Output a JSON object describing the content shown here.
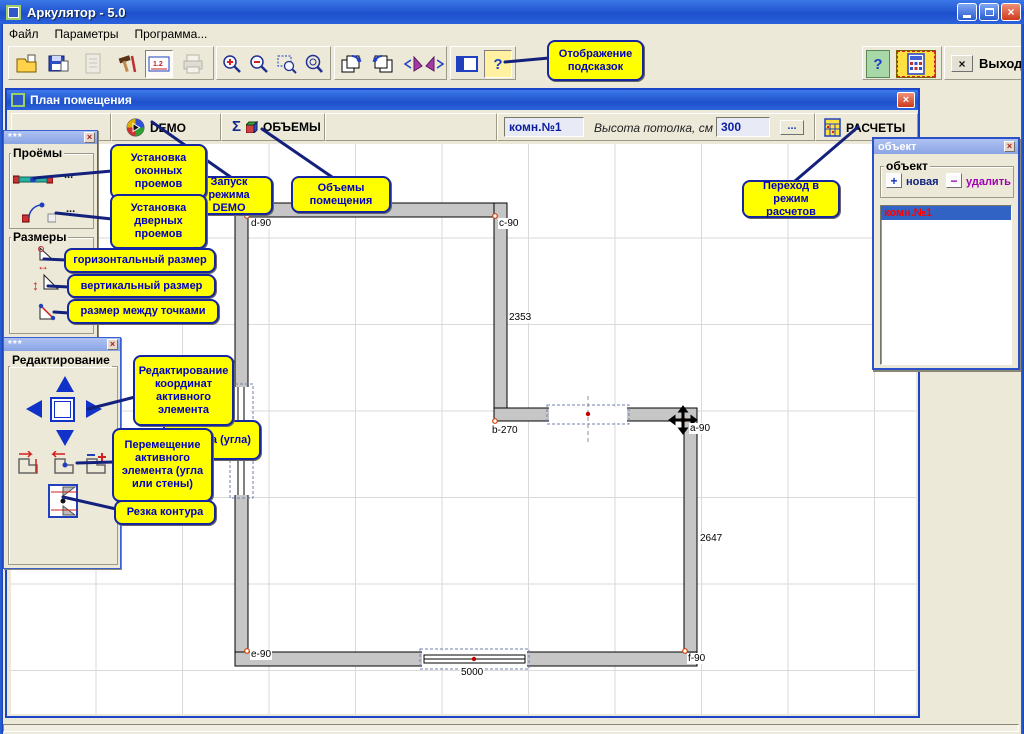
{
  "theme": {
    "titlebar_blue": "#2A63DC",
    "tooltip_bg": "#FFFF00",
    "tooltip_ink": "#0000C0",
    "wall_fill": "#C6C6C6",
    "selection_blue": "#3163C5",
    "selected_text_red": "#FF0000",
    "delete_purple": "#A000B4",
    "accent_blue": "#14217C"
  },
  "window": {
    "title": "Аркулятор - 5.0"
  },
  "menu": {
    "items": [
      "Файл",
      "Параметры",
      "Программа..."
    ]
  },
  "toolbar": {
    "exit_label": "Выход"
  },
  "glyphs": {
    "close": "×",
    "help": "?",
    "sigma": "Σ",
    "play": "▶",
    "arrow_h": "↔",
    "arrow_v": "↕",
    "dots": "...",
    "dim_sample": "1.2",
    "plus": "+",
    "minus": "−",
    "exit_x": "×"
  },
  "plan_window": {
    "title": "План помещения",
    "demo_label": "DEMO",
    "volumes_label": "ОБЪЕМЫ",
    "room_name": "комн.№1",
    "ceiling_label": "Высота потолка, см -",
    "ceiling_value": "300",
    "more_label": "...",
    "calc_label": "РАСЧЕТЫ"
  },
  "panels": {
    "tools1": {
      "title": "***",
      "openings_group": "Проёмы",
      "sizes_group": "Размеры",
      "window_more": "...",
      "door_more": "..."
    },
    "tools2": {
      "title": "***",
      "group": "Редактирование"
    },
    "object": {
      "title": "объект",
      "group": "объект",
      "new_label": "новая",
      "delete_label": "удалить",
      "items": [
        {
          "label": "комн.№1"
        }
      ]
    }
  },
  "tooltips": [
    {
      "id": "hints",
      "text": "Отображение подсказок"
    },
    {
      "id": "windows",
      "text": "Установка оконных проемов"
    },
    {
      "id": "doors",
      "text": "Установка дверных проемов"
    },
    {
      "id": "demo",
      "text": "Запуск режима DEMO"
    },
    {
      "id": "volumes",
      "text": "Объемы помещения"
    },
    {
      "id": "calc",
      "text": "Переход в режим расчетов"
    },
    {
      "id": "hdim",
      "text": "горизонтальный размер"
    },
    {
      "id": "vdim",
      "text": "вертикальный размер"
    },
    {
      "id": "pdim",
      "text": "размер между точками"
    },
    {
      "id": "coords",
      "text": "Редактирование координат активного элемента"
    },
    {
      "id": "insert",
      "text": "Вставка (угла)"
    },
    {
      "id": "move",
      "text": "Перемещение активного элемента (угла или стены)"
    },
    {
      "id": "cut",
      "text": "Резка контура"
    }
  ],
  "plan": {
    "corners": [
      {
        "label": "d-90"
      },
      {
        "label": "c-90"
      },
      {
        "label": "b-270"
      },
      {
        "label": "a-90"
      },
      {
        "label": "e-90"
      },
      {
        "label": "f-90"
      }
    ],
    "dims": [
      {
        "label": "2353"
      },
      {
        "label": "2647"
      },
      {
        "label": "5000"
      }
    ]
  }
}
